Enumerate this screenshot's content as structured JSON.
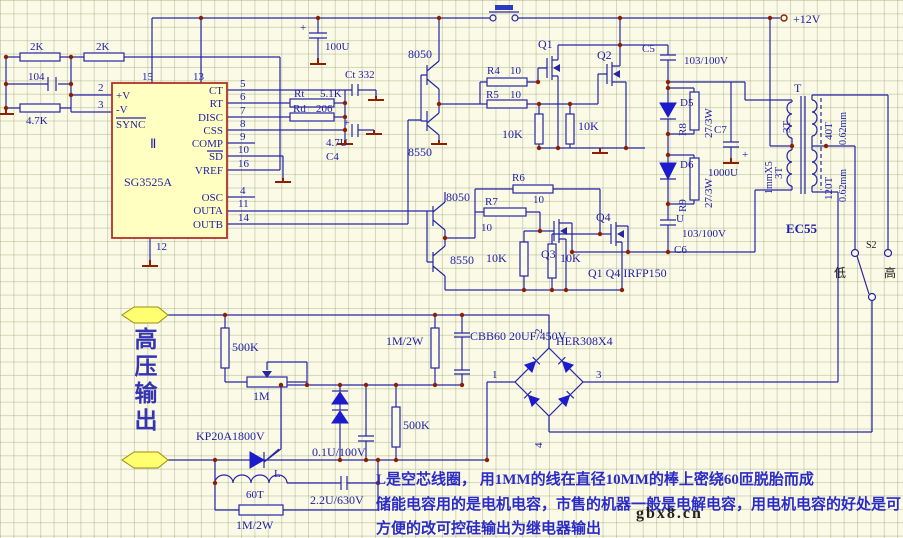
{
  "colors": {
    "bg": "#fbfae6",
    "grid": "#c6cda8",
    "wire": "#2626a6",
    "junction": "#8c2000",
    "ic_fill": "#ffffc2",
    "ic_border": "#b23228",
    "diode_blue": "#1c1ccd",
    "connector_yellow": "#ffff70",
    "note_blue": "#2b2bc8",
    "label_blue": "#1d1daa",
    "black_text": "#1a1a1a"
  },
  "top_left": {
    "r1": "2K",
    "r2": "2K",
    "c1": "104",
    "r3": "4.7K"
  },
  "ic": {
    "part": "SG3525A",
    "des": "Ⅱ",
    "pv": "+V",
    "nv": "-V",
    "sync": "SYNC",
    "p2": "2",
    "p3": "3",
    "p15": "15",
    "p13": "13",
    "p12": "12",
    "pins": [
      {
        "n": "5",
        "l": "CT"
      },
      {
        "n": "6",
        "l": "RT"
      },
      {
        "n": "7",
        "l": "DISC"
      },
      {
        "n": "8",
        "l": "CSS"
      },
      {
        "n": "9",
        "l": "COMP"
      },
      {
        "n": "10",
        "l": "SD"
      },
      {
        "n": "16",
        "l": "VREF"
      },
      {
        "n": "4",
        "l": "OSC"
      },
      {
        "n": "11",
        "l": "OUTA"
      },
      {
        "n": "14",
        "l": "OUTB"
      }
    ]
  },
  "osc_net": {
    "c100u": "100U",
    "plus": "+",
    "ct": "Ct 332",
    "rt": "Rt",
    "rt_v": "5.1K",
    "rd": "Rd",
    "rd_v": "206",
    "c4_v": "4.7U",
    "c4": "C4"
  },
  "driver": {
    "q8050a": "8050",
    "q8550a": "8550",
    "q8050b": "8050",
    "q8550b": "8550",
    "r4": "R4",
    "r4_v": "10",
    "r5": "R5",
    "r5_v": "10",
    "r6": "R6",
    "r6_v": "10",
    "r7": "R7",
    "r7_v": "10",
    "r10k_a": "10K",
    "r10k_b": "10K",
    "r10k_c": "10K",
    "r10k_d": "10K"
  },
  "power": {
    "vcc": "+12V",
    "q1": "Q1",
    "q2": "Q2",
    "q3": "Q3",
    "q4": "Q4",
    "note": "Q1 Q4 IRFP150",
    "c5": "C5",
    "c5_v": "103/100V",
    "d5": "D5",
    "r8": "R8",
    "r8_v": "27/3W",
    "c7": "C7",
    "c7_v": "1000U",
    "plus": "+",
    "d6": "D6",
    "r9": "R9",
    "r9_v": "27/3W",
    "u": "U",
    "c6_v": "103/100V",
    "c6": "C6"
  },
  "xfmr": {
    "t": "T",
    "p1": "3T",
    "p2": "3T",
    "pw": "1mmX5",
    "s1": "40T",
    "s1w": "0.62mm",
    "s2": "120T",
    "s2w": "0.62mm",
    "core": "EC55"
  },
  "sel": {
    "s": "S2",
    "low": "低",
    "high": "高"
  },
  "hv": {
    "out": "高压输出",
    "r500k_a": "500K",
    "pot": "1M",
    "scr": "KP20A1800V",
    "l": "L",
    "l_t": "60T",
    "c01": "0.1U/100V",
    "c22": "2.2U/630V",
    "r1m2w_a": "1M/2W",
    "r1m2w_b": "1M/2W",
    "r500k_b": "500K",
    "cbb": "CBB60 20UF/450V",
    "bridge": "HER308X4",
    "n1": "1",
    "n2": "2",
    "n3": "3",
    "n4": "4"
  },
  "notes": {
    "l1": "L是空芯线圈， 用1MM的线在直径10MM的棒上密绕60匝脱胎而成",
    "l2": "储能电容用的是电机电容，市售的机器一般是电解电容，用电机电容的好处是可",
    "l3": "方便的改可控硅输出为继电器输出",
    "wm": "gbx8.cn"
  }
}
